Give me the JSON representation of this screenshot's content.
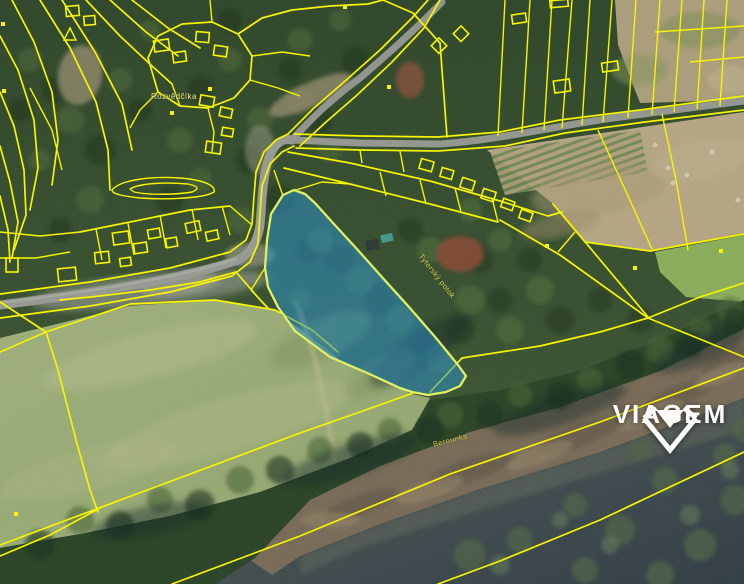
{
  "map": {
    "labels": [
      {
        "text": "Rozvědčíka"
      },
      {
        "text": "Tyterský potok"
      },
      {
        "text": "Berounka"
      }
    ],
    "colors": {
      "cadastral_line": "#f6f400",
      "highlight_fill": "#2e8fc4",
      "highlight_stroke": "#dff063"
    }
  },
  "watermark": {
    "brand": "VIAGEM"
  }
}
